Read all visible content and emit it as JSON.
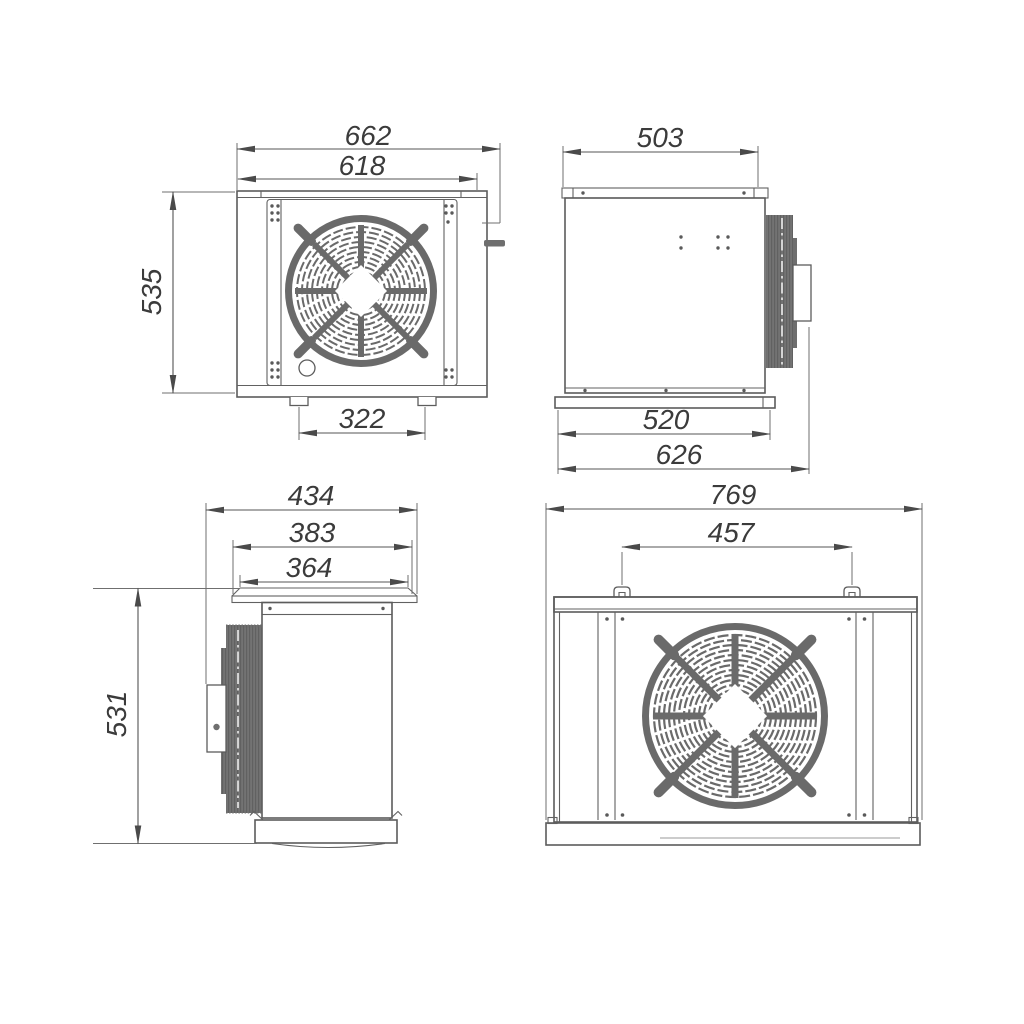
{
  "views": {
    "front": {
      "overall_width": "662",
      "body_width": "618",
      "height": "535",
      "feet_spacing": "322"
    },
    "side_right": {
      "top_width": "503",
      "base_width": "520",
      "overall_depth": "626"
    },
    "side_left": {
      "overall_depth": "434",
      "flange_width": "383",
      "opening_width": "364",
      "height": "531"
    },
    "rear": {
      "overall_width": "769",
      "mount_spacing": "457"
    }
  },
  "colors": {
    "object_line": "#5c5c5c",
    "dimension_line": "#545454",
    "text": "#3b3b3b",
    "dark_fill": "#6e6e6e",
    "background": "#ffffff"
  }
}
